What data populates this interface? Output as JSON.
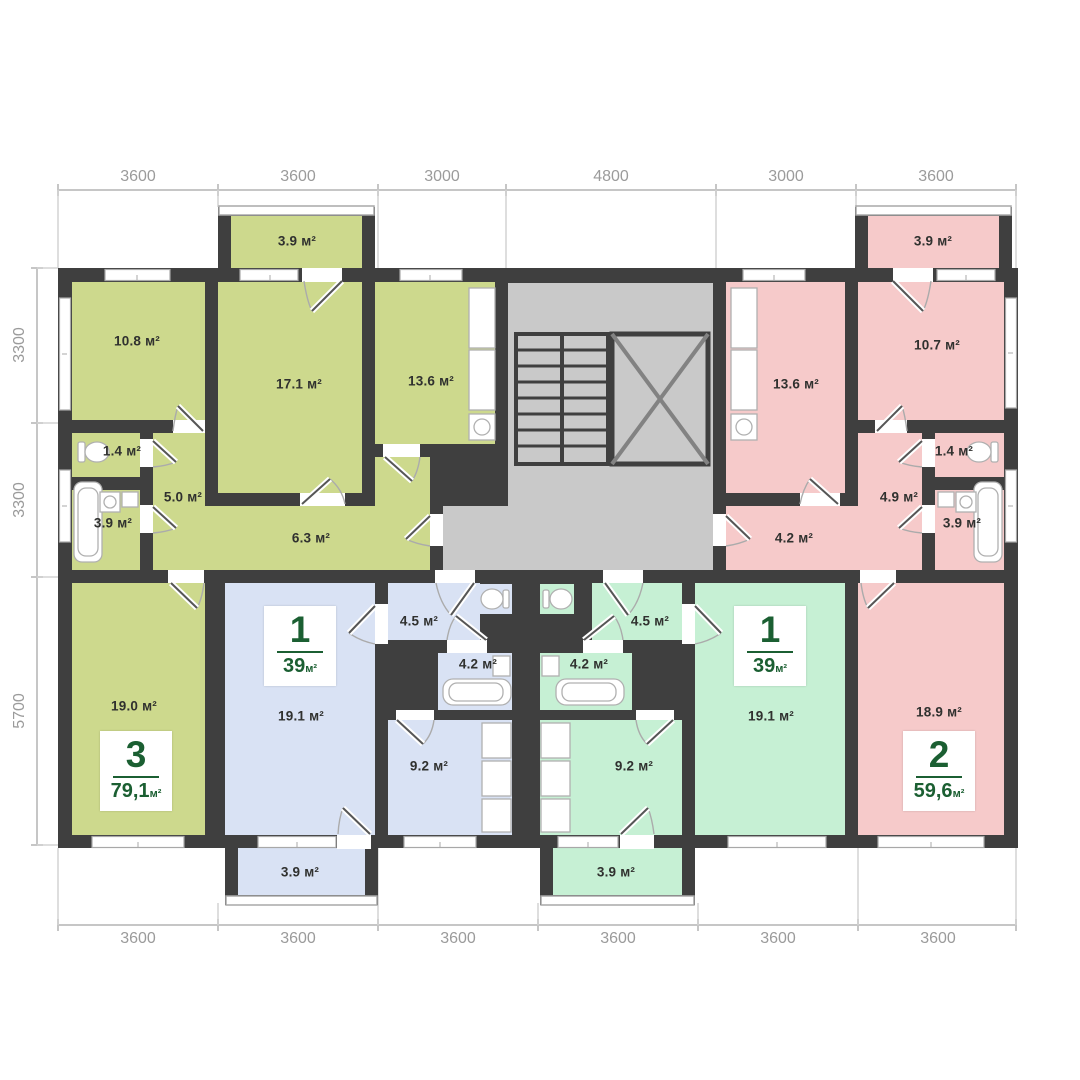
{
  "plan": {
    "type": "apartment-floor-plan",
    "colors": {
      "apartment_3_fill": "#cdd98d",
      "apartment_1_left_fill": "#d9e2f4",
      "apartment_1_right_fill": "#c6f0d4",
      "apartment_2_fill": "#f6caca",
      "stairwell_fill": "#c9c9c9",
      "wall": "#3f3f3f",
      "badge_text": "#1b5f32",
      "dimension_text": "#9b9b9b"
    }
  },
  "dimensions": {
    "top": [
      "3600",
      "3600",
      "3000",
      "4800",
      "3000",
      "3600"
    ],
    "left": [
      "3300",
      "3300",
      "5700"
    ],
    "bottom": [
      "3600",
      "3600",
      "3600",
      "3600",
      "3600",
      "3600"
    ]
  },
  "apartments": {
    "apt3": {
      "number": "3",
      "area": "79,1",
      "unit": "м²"
    },
    "apt1a": {
      "number": "1",
      "area": "39",
      "unit": "м²"
    },
    "apt1b": {
      "number": "1",
      "area": "39",
      "unit": "м²"
    },
    "apt2": {
      "number": "2",
      "area": "59,6",
      "unit": "м²"
    }
  },
  "rooms": {
    "g_balcony": "3.9 м²",
    "g_bed": "10.8 м²",
    "g_living": "17.1 м²",
    "g_kitchen": "13.6 м²",
    "g_wc": "1.4 м²",
    "g_hall": "5.0 м²",
    "g_bath": "3.9 м²",
    "g_corridor": "6.3 м²",
    "g_room2": "19.0 м²",
    "b_hall": "4.5 м²",
    "b_bath": "4.2 м²",
    "b_kitchen": "9.2 м²",
    "b_room": "19.1 м²",
    "b_balcony": "3.9 м²",
    "m_hall": "4.5 м²",
    "m_bath": "4.2 м²",
    "m_kitchen": "9.2 м²",
    "m_room": "19.1 м²",
    "m_balcony": "3.9 м²",
    "p_balcony": "3.9 м²",
    "p_kitchen": "13.6 м²",
    "p_bed": "10.7 м²",
    "p_wc": "1.4 м²",
    "p_hall": "4.9 м²",
    "p_bath": "3.9 м²",
    "p_corridor": "4.2 м²",
    "p_room": "18.9 м²"
  }
}
